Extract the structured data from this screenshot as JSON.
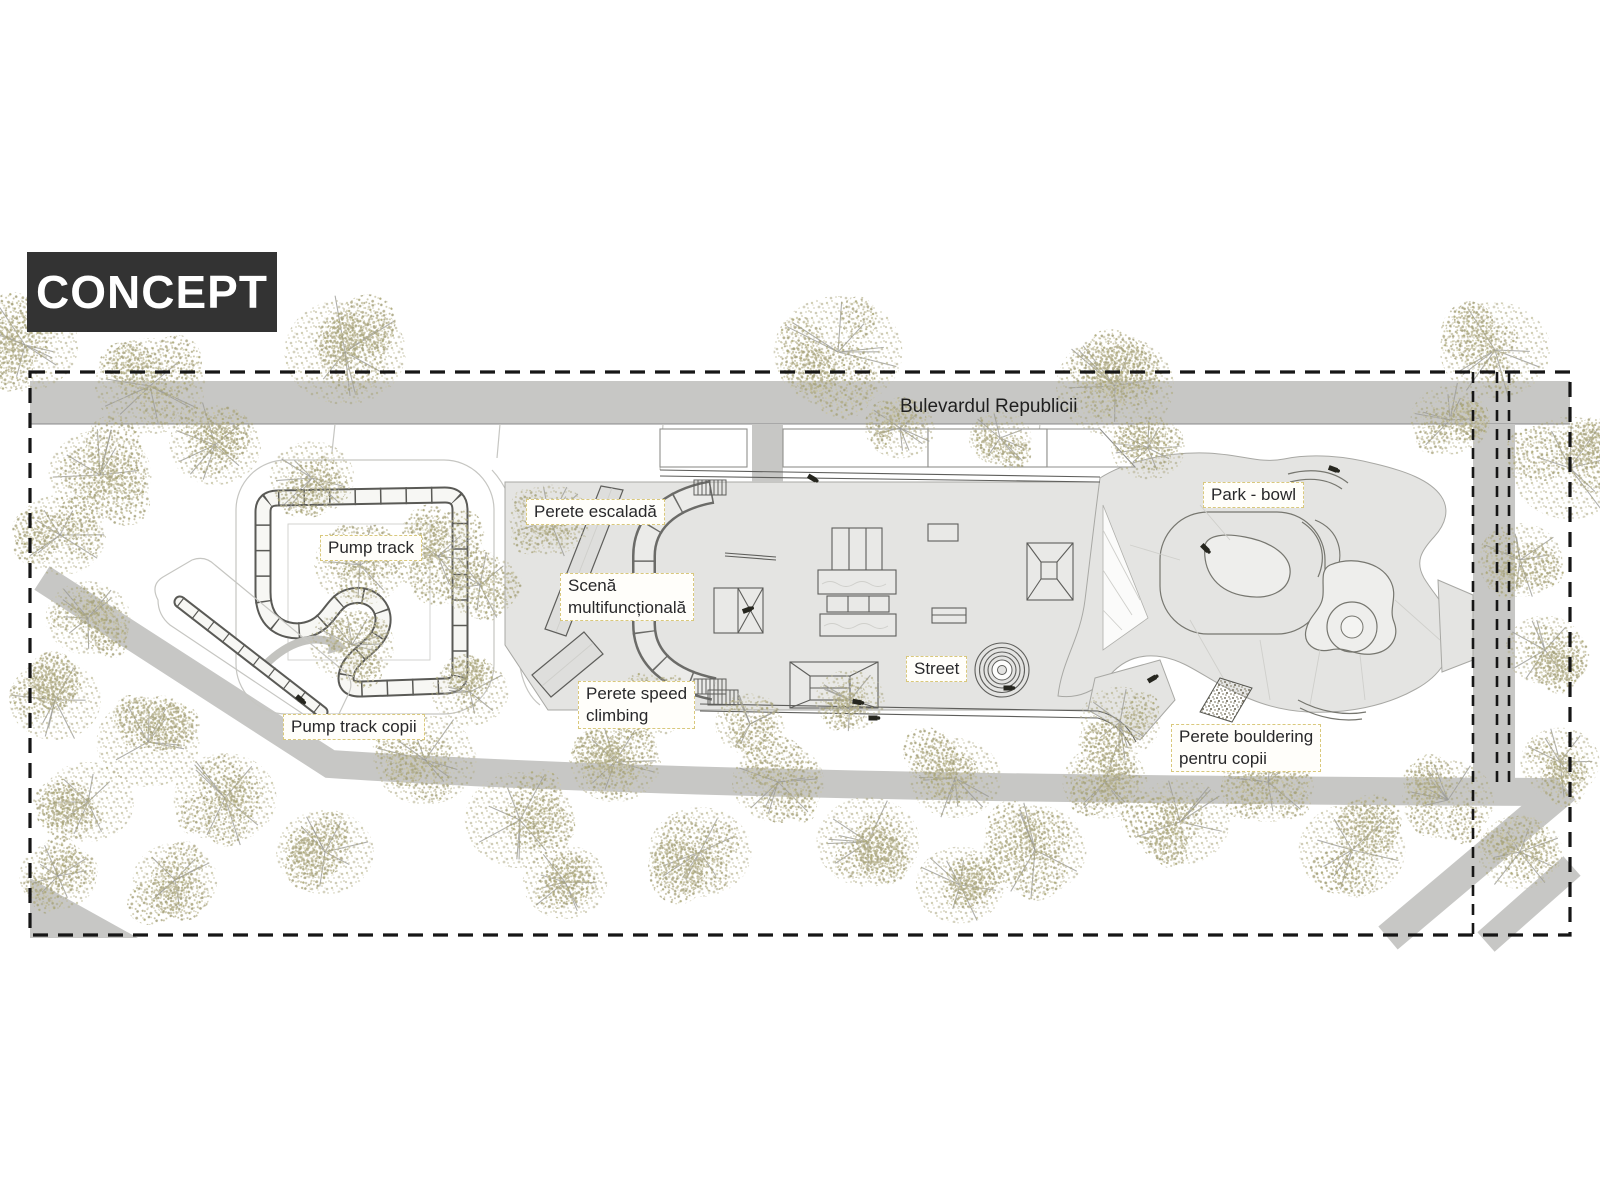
{
  "title": {
    "label": "CONCEPT"
  },
  "road": {
    "label": "Bulevardul Republicii"
  },
  "labels": [
    {
      "id": "pump-track",
      "lines": [
        "Pump track"
      ],
      "x": 320,
      "y": 535
    },
    {
      "id": "perete-escalada",
      "lines": [
        "Perete escaladă"
      ],
      "x": 526,
      "y": 499
    },
    {
      "id": "scena-multifunctionala",
      "lines": [
        "Scenă",
        "multifuncțională"
      ],
      "x": 560,
      "y": 573
    },
    {
      "id": "park-bowl",
      "lines": [
        "Park - bowl"
      ],
      "x": 1203,
      "y": 482
    },
    {
      "id": "street",
      "lines": [
        "Street"
      ],
      "x": 906,
      "y": 656
    },
    {
      "id": "perete-speed-climbing",
      "lines": [
        "Perete speed",
        "climbing"
      ],
      "x": 578,
      "y": 681
    },
    {
      "id": "pump-track-copii",
      "lines": [
        "Pump track copii"
      ],
      "x": 283,
      "y": 714
    },
    {
      "id": "perete-bouldering",
      "lines": [
        "Perete bouldering",
        "pentru copii"
      ],
      "x": 1171,
      "y": 724
    }
  ],
  "colors": {
    "concept_bg": "#333333",
    "concept_text": "#ffffff",
    "road": "#c7c7c5",
    "plaza": "#e4e4e2",
    "outline": "#5e5e5b",
    "light_outline": "#c6c6c2",
    "label_border": "#d9c87c",
    "label_bg": "#fffefa",
    "label_text": "#28282a",
    "boundary": "#161616",
    "tree_dot_dark": "#a7a37e",
    "tree_dot_light": "#c8c4a4",
    "branch": "#9b9b96"
  },
  "trees": [
    [
      25,
      345,
      58
    ],
    [
      150,
      386,
      60
    ],
    [
      345,
      352,
      66
    ],
    [
      838,
      352,
      70
    ],
    [
      1115,
      386,
      64
    ],
    [
      1495,
      350,
      60
    ],
    [
      1570,
      468,
      64
    ],
    [
      100,
      475,
      56
    ],
    [
      215,
      445,
      50
    ],
    [
      60,
      535,
      50
    ],
    [
      312,
      478,
      46
    ],
    [
      438,
      556,
      50
    ],
    [
      352,
      645,
      46
    ],
    [
      550,
      520,
      44
    ],
    [
      480,
      585,
      42
    ],
    [
      360,
      565,
      50
    ],
    [
      88,
      618,
      46
    ],
    [
      55,
      700,
      50
    ],
    [
      148,
      742,
      56
    ],
    [
      88,
      802,
      50
    ],
    [
      225,
      798,
      56
    ],
    [
      325,
      852,
      53
    ],
    [
      175,
      880,
      46
    ],
    [
      58,
      876,
      42
    ],
    [
      425,
      760,
      56
    ],
    [
      520,
      820,
      60
    ],
    [
      615,
      762,
      50
    ],
    [
      700,
      852,
      56
    ],
    [
      778,
      782,
      50
    ],
    [
      868,
      842,
      56
    ],
    [
      955,
      778,
      50
    ],
    [
      1035,
      850,
      56
    ],
    [
      1105,
      782,
      46
    ],
    [
      565,
      882,
      46
    ],
    [
      960,
      885,
      48
    ],
    [
      470,
      692,
      42
    ],
    [
      650,
      706,
      40
    ],
    [
      750,
      724,
      38
    ],
    [
      850,
      700,
      38
    ],
    [
      1120,
      722,
      44
    ],
    [
      1180,
      822,
      54
    ],
    [
      1268,
      782,
      50
    ],
    [
      1352,
      850,
      58
    ],
    [
      1448,
      800,
      50
    ],
    [
      1520,
      852,
      46
    ],
    [
      1560,
      762,
      43
    ],
    [
      1450,
      420,
      43
    ],
    [
      1520,
      560,
      46
    ],
    [
      1545,
      650,
      43
    ],
    [
      900,
      428,
      38
    ],
    [
      1000,
      438,
      34
    ],
    [
      1148,
      448,
      40
    ]
  ],
  "markers": [
    {
      "x": 812,
      "y": 478,
      "rot": 30
    },
    {
      "x": 747,
      "y": 610,
      "rot": -20
    },
    {
      "x": 857,
      "y": 702,
      "rot": 10
    },
    {
      "x": 1008,
      "y": 688,
      "rot": 0
    },
    {
      "x": 1205,
      "y": 548,
      "rot": 45
    },
    {
      "x": 1333,
      "y": 469,
      "rot": 20
    },
    {
      "x": 1152,
      "y": 679,
      "rot": -30
    },
    {
      "x": 300,
      "y": 699,
      "rot": 40
    },
    {
      "x": 873,
      "y": 718,
      "rot": 0
    }
  ]
}
